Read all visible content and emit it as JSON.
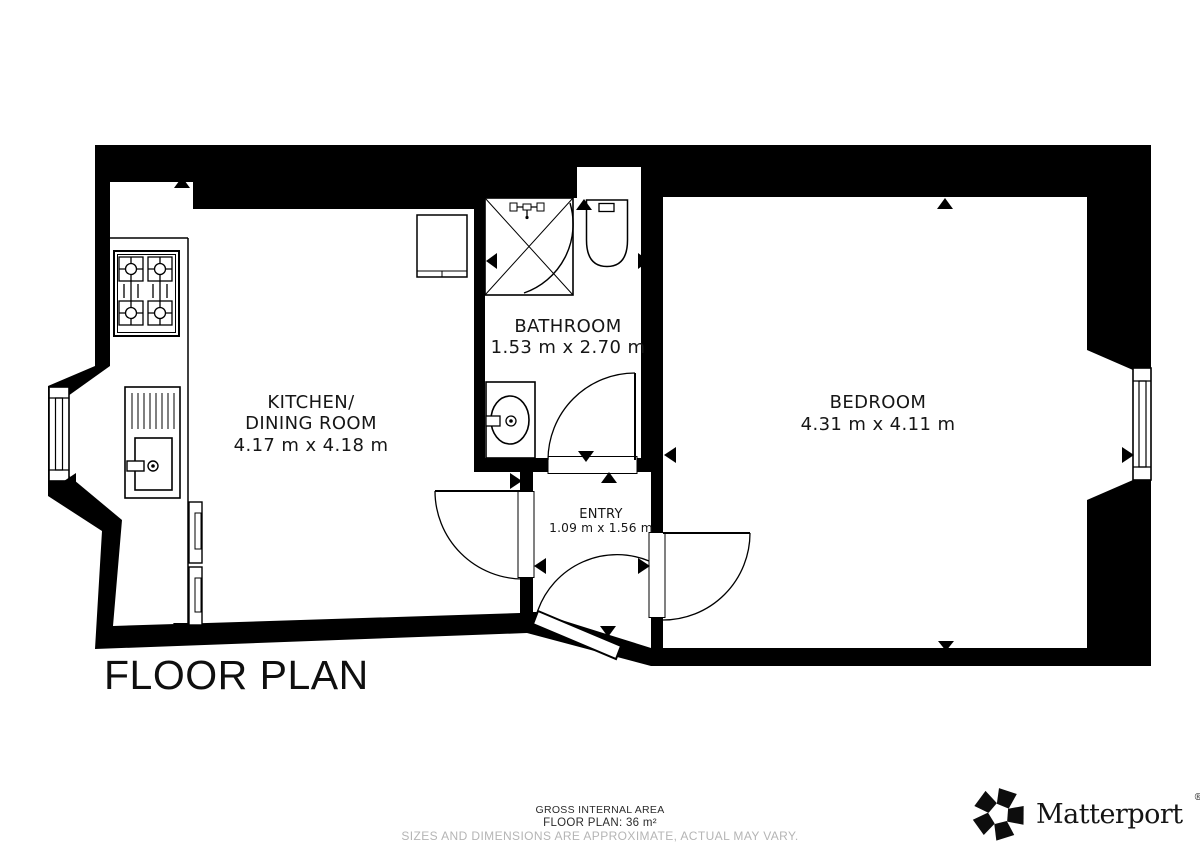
{
  "plan": {
    "title": "FLOOR PLAN",
    "rooms": {
      "kitchen": {
        "line1": "KITCHEN/",
        "line2": "DINING ROOM",
        "dims": "4.17 m x 4.18 m"
      },
      "bathroom": {
        "name": "BATHROOM",
        "dims": "1.53 m x 2.70 m"
      },
      "bedroom": {
        "name": "BEDROOM",
        "dims": "4.31 m x 4.11 m"
      },
      "entry": {
        "name": "ENTRY",
        "dims": "1.09 m x 1.56 m"
      }
    },
    "fixtures": [
      "gas-stove",
      "kitchen-counter",
      "kitchen-sink",
      "kitchen-cabinets",
      "storage-unit",
      "shower",
      "shower-mixer",
      "toilet",
      "bathroom-sink",
      "window-left",
      "window-right"
    ],
    "doors": [
      "entry-door",
      "kitchen-door",
      "bathroom-door",
      "bedroom-door"
    ],
    "dimension_arrows": [
      "up",
      "down",
      "left",
      "right"
    ]
  },
  "footer": {
    "area_title": "GROSS INTERNAL AREA",
    "area_value": "FLOOR PLAN: 36 m²",
    "disclaimer": "SIZES AND DIMENSIONS ARE APPROXIMATE, ACTUAL MAY VARY."
  },
  "brand": {
    "name": "Matterport",
    "registered": "®"
  },
  "colors": {
    "wall": "#000000",
    "background": "#ffffff",
    "text": "#161616",
    "muted_text": "#b5b5b5"
  }
}
